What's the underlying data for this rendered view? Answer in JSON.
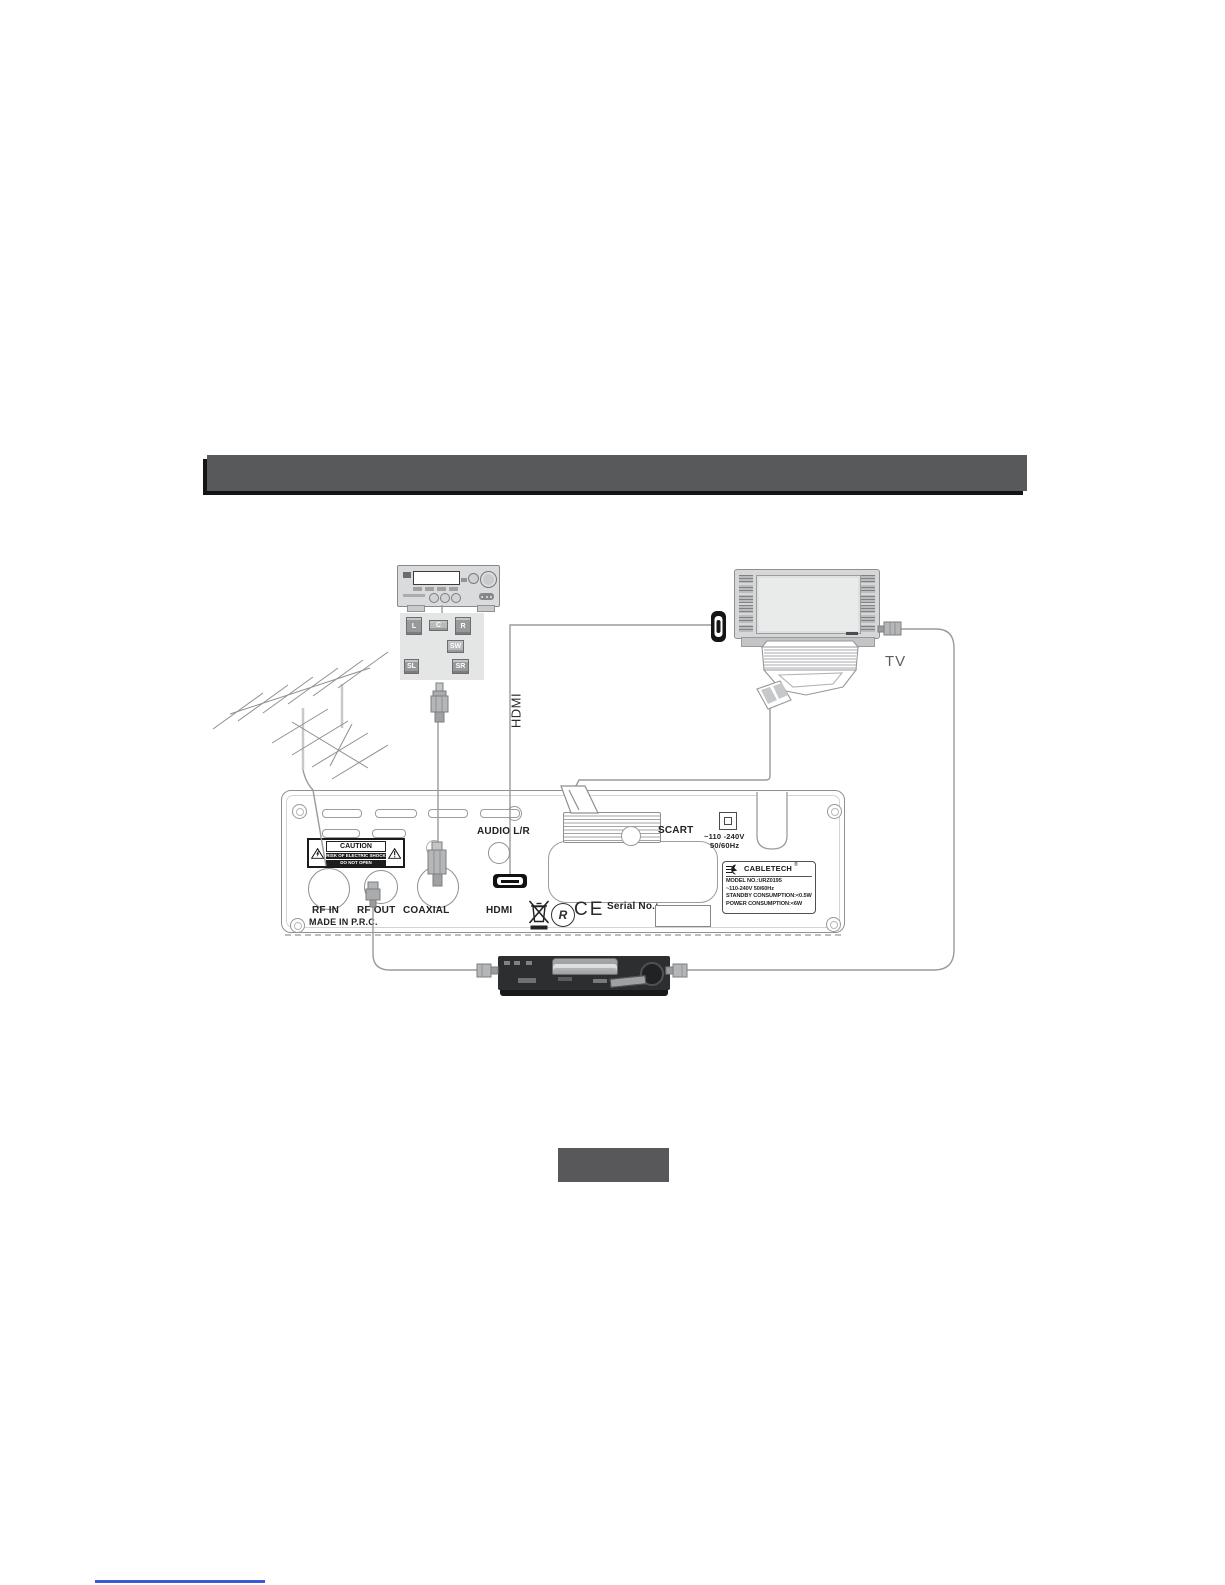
{
  "diagram": {
    "hdmi_cable_label": "HDMI",
    "tv_label": "TV",
    "speakers": [
      "L",
      "C",
      "R",
      "SW",
      "SL",
      "SR"
    ]
  },
  "panel": {
    "caution_title": "CAUTION",
    "caution_line1": "RISK OF ELECTRIC SHOCK",
    "caution_line2": "DO NOT OPEN",
    "audio_label": "AUDIO L/R",
    "rf_in_label": "RF IN",
    "rf_out_label": "RF OUT",
    "coaxial_label": "COAXIAL",
    "hdmi_label": "HDMI",
    "scart_label": "SCART",
    "power_line1": "~110 -240V",
    "power_line2": "50/60Hz",
    "made_in": "MADE IN P.R.C.",
    "serial_label": "Serial No.:",
    "ce_mark": "CE",
    "r_mark": "R",
    "rating": {
      "brand": "CABLETECH",
      "reg": "®",
      "model": "MODEL NO.:URZ0195",
      "voltage": "~110-240V  50/60Hz",
      "standby": "STANDBY CONSUMPTION:<0.5W",
      "power": "POWER CONSUMPTION:<6W"
    }
  },
  "colors": {
    "header_bar": "#58595b",
    "header_shadow": "#141414",
    "section_box": "#58585a",
    "line": "#9a9a9a",
    "link_line": "#3b5bd6"
  }
}
